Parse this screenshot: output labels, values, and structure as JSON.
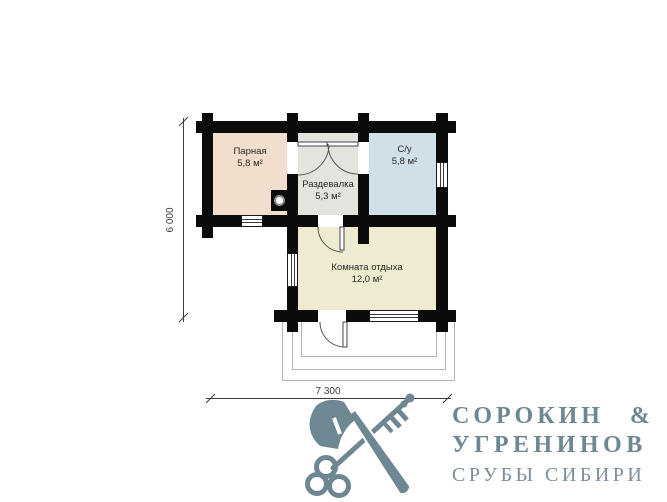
{
  "plan": {
    "rooms": [
      {
        "name": "Парная",
        "area": "5,8 м²"
      },
      {
        "name": "Раздевалка",
        "area": "5,3 м²"
      },
      {
        "name": "С/у",
        "area": "5,8 м²"
      },
      {
        "name": "Комната отдыха",
        "area": "12,0 м²"
      }
    ],
    "dimensions": {
      "width_label": "7 300",
      "height_label": "6 000"
    },
    "colors": {
      "wall": "#0b0b0b",
      "parnaya_fill": "#f2decd",
      "razdevalka_fill": "#e4e3dd",
      "su_fill": "#d0e0e8",
      "komnata_fill": "#efebd0",
      "porch_line": "#b5b5b5"
    }
  },
  "logo": {
    "icon": "crossed-axe-and-key-icon",
    "line1": "СОРОКИН &",
    "line2": "УГРЕНИНОВ",
    "line3": "СРУБЫ СИБИРИ",
    "color": "#6e8893"
  }
}
